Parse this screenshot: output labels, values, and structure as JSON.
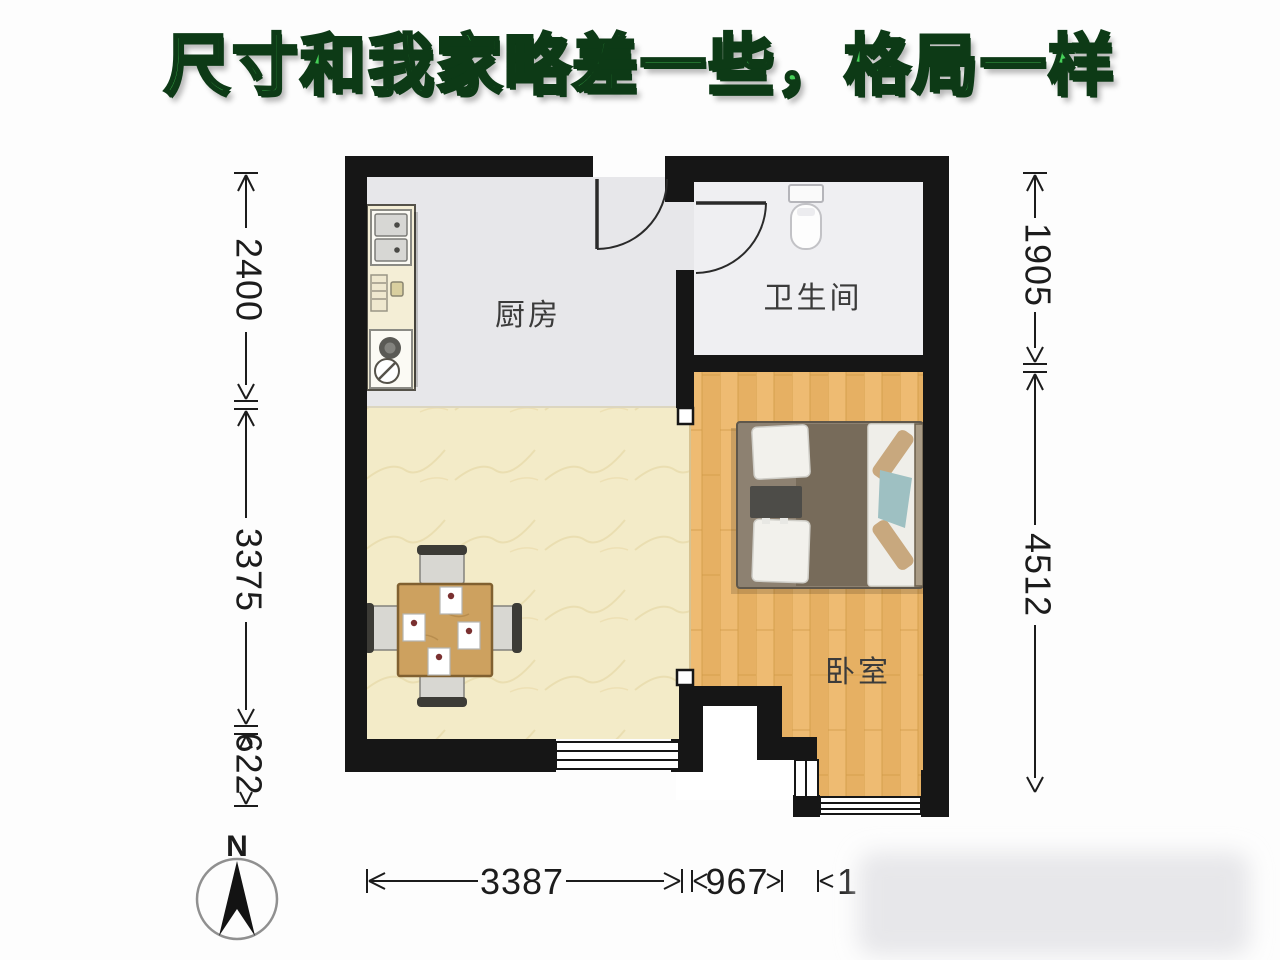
{
  "title": "尺寸和我家略差一些，格局一样",
  "rooms": {
    "kitchen": "厨房",
    "bathroom": "卫生间",
    "bedroom": "卧室"
  },
  "dimensions": {
    "left_top": "2400",
    "left_middle": "3375",
    "left_bottom": "622",
    "right_top": "1905",
    "right_bottom": "4512",
    "bottom_left": "3387",
    "bottom_middle": "967",
    "bottom_right_partial": "1"
  },
  "compass": {
    "north": "N"
  },
  "colors": {
    "wall": "#161616",
    "title_green": "#46d058",
    "kitchen_floor": "#e7e7ea",
    "bathroom_floor": "#efeff2",
    "living_floor": "#f3ebc8",
    "bedroom_floor": "#ecba6e"
  }
}
